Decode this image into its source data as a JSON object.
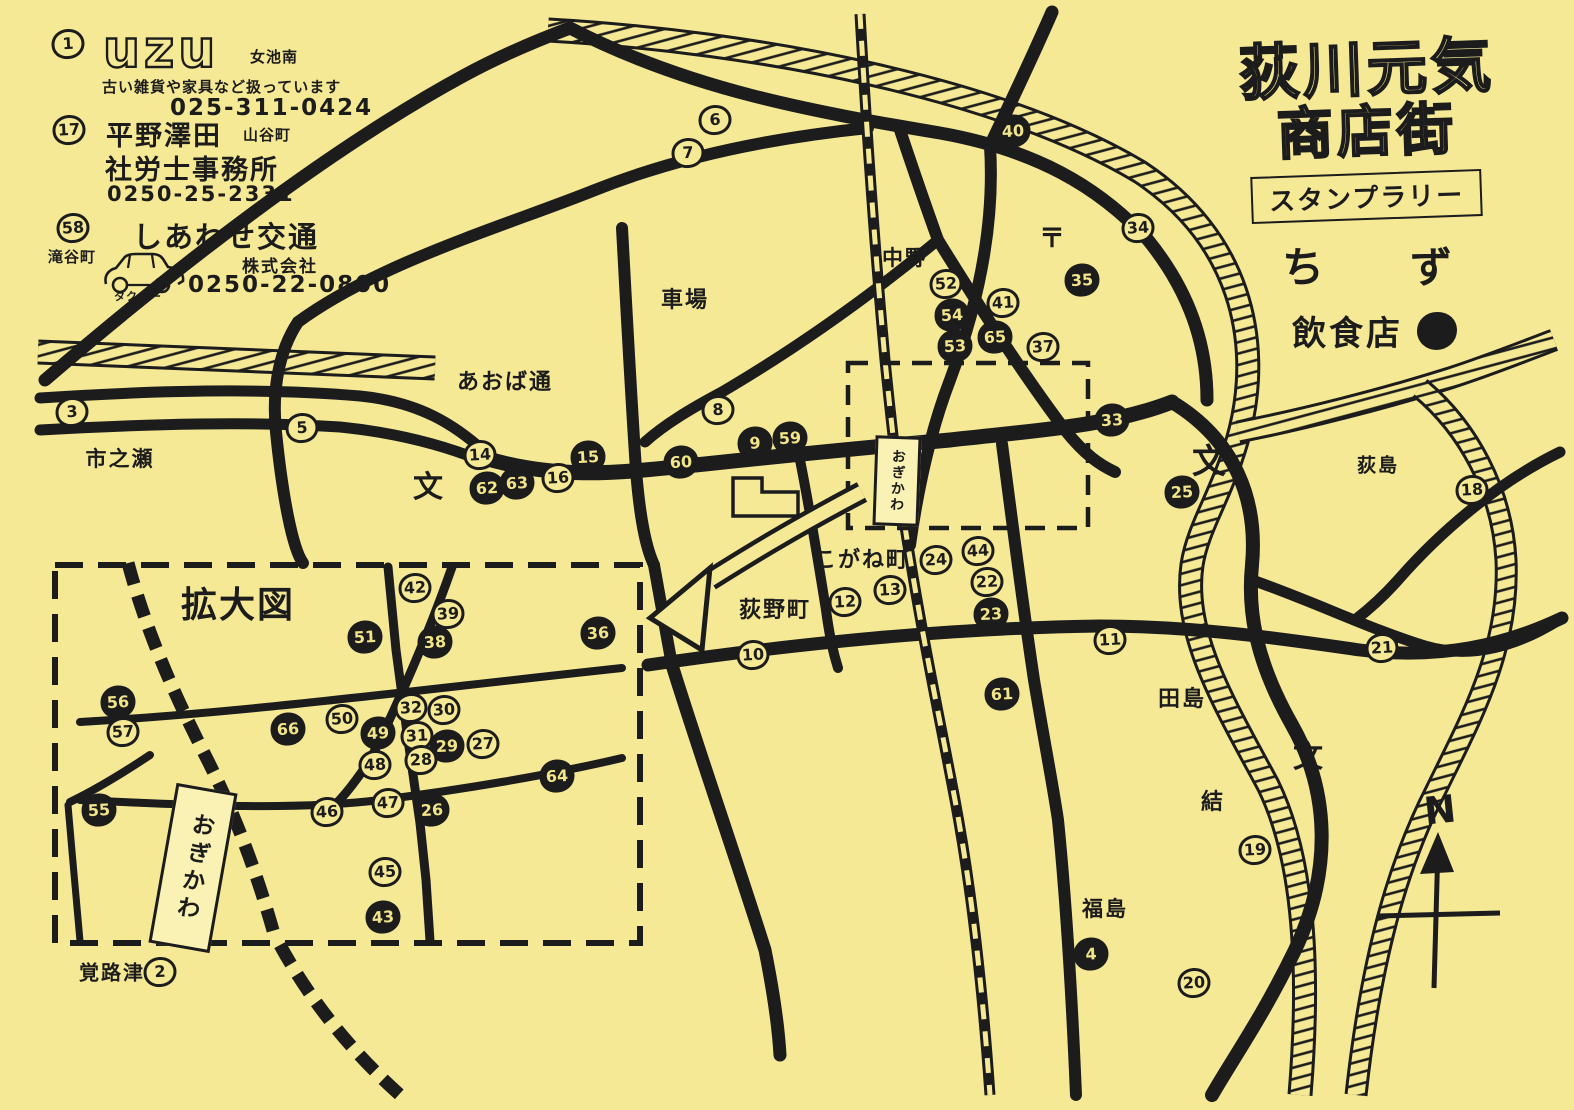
{
  "page": {
    "paper_color": "#f5e996",
    "ink_color": "#1c1c1c"
  },
  "title": {
    "line1": "荻川元気",
    "line2": "商店街",
    "banner": "スタンプラリー",
    "subtitle_char1": "ち",
    "subtitle_char2": "ず"
  },
  "legend": {
    "label": "飲食店",
    "symbol": "filled-circle"
  },
  "compass": {
    "label": "N"
  },
  "ads": [
    {
      "number": "1",
      "logo": "uzu",
      "area": "女池南",
      "description": "古い雑貨や家具など扱っています",
      "phone": "025-311-0424"
    },
    {
      "number": "17",
      "line1": "平野澤田",
      "area": "山谷町",
      "line2": "社労士事務所",
      "phone": "0250-25-2331"
    },
    {
      "number": "58",
      "line1": "しあわせ交通",
      "line2": "株式会社",
      "area": "滝谷町",
      "icon": "taxi",
      "icon_label": "タクシー",
      "phone": "0250-22-0800"
    }
  ],
  "map": {
    "inset_label": "拡大図",
    "station_name": "おぎかわ",
    "stations": [
      {
        "name": "おぎかわ",
        "x": 897,
        "y": 481,
        "w": 46,
        "h": 90,
        "rot": 2,
        "font": 14,
        "spacing": 2
      },
      {
        "name": "おぎかわ",
        "x": 193,
        "y": 868,
        "w": 62,
        "h": 162,
        "rot": 10,
        "font": 23,
        "spacing": 5
      }
    ],
    "places": [
      {
        "text": "市之瀬",
        "x": 120,
        "y": 458,
        "size": 21
      },
      {
        "text": "あおば通",
        "x": 505,
        "y": 380,
        "size": 22
      },
      {
        "text": "車場",
        "x": 685,
        "y": 298,
        "size": 22
      },
      {
        "text": "中野",
        "x": 905,
        "y": 257,
        "size": 21
      },
      {
        "text": "こがね町",
        "x": 862,
        "y": 558,
        "size": 22
      },
      {
        "text": "荻野町",
        "x": 775,
        "y": 608,
        "size": 22
      },
      {
        "text": "田島",
        "x": 1182,
        "y": 697,
        "size": 22
      },
      {
        "text": "結",
        "x": 1213,
        "y": 800,
        "size": 22
      },
      {
        "text": "福島",
        "x": 1105,
        "y": 908,
        "size": 21
      },
      {
        "text": "荻島",
        "x": 1378,
        "y": 464,
        "size": 19
      },
      {
        "text": "覚路津",
        "x": 112,
        "y": 971,
        "size": 20
      },
      {
        "text": "拡大図",
        "x": 238,
        "y": 602,
        "size": 36
      }
    ],
    "symbols": [
      {
        "char": "文",
        "meaning": "school",
        "x": 428,
        "y": 488,
        "size": 30
      },
      {
        "char": "文",
        "meaning": "school",
        "x": 1209,
        "y": 462,
        "size": 34
      },
      {
        "char": "文",
        "meaning": "school",
        "x": 1308,
        "y": 758,
        "size": 30
      },
      {
        "char": "〒",
        "meaning": "post-office",
        "x": 1052,
        "y": 239,
        "size": 26
      }
    ],
    "markers": [
      {
        "label": "1",
        "x": 68,
        "y": 44,
        "filled": false,
        "area": "ad"
      },
      {
        "label": "17",
        "x": 69,
        "y": 130,
        "filled": false,
        "area": "ad"
      },
      {
        "label": "58",
        "x": 73,
        "y": 228,
        "filled": false,
        "area": "ad"
      },
      {
        "label": "3",
        "x": 72,
        "y": 412,
        "filled": false,
        "area": "main"
      },
      {
        "label": "5",
        "x": 302,
        "y": 428,
        "filled": false,
        "area": "main"
      },
      {
        "label": "6",
        "x": 715,
        "y": 120,
        "filled": false,
        "area": "main"
      },
      {
        "label": "7",
        "x": 688,
        "y": 153,
        "filled": false,
        "area": "main"
      },
      {
        "label": "8",
        "x": 718,
        "y": 410,
        "filled": false,
        "area": "main"
      },
      {
        "label": "14",
        "x": 480,
        "y": 455,
        "filled": false,
        "area": "main"
      },
      {
        "label": "62",
        "x": 487,
        "y": 488,
        "filled": true,
        "area": "main"
      },
      {
        "label": "63",
        "x": 517,
        "y": 483,
        "filled": true,
        "area": "main"
      },
      {
        "label": "16",
        "x": 558,
        "y": 478,
        "filled": false,
        "area": "main"
      },
      {
        "label": "15",
        "x": 588,
        "y": 457,
        "filled": true,
        "area": "main"
      },
      {
        "label": "60",
        "x": 681,
        "y": 462,
        "filled": true,
        "area": "main"
      },
      {
        "label": "9",
        "x": 755,
        "y": 443,
        "filled": true,
        "area": "main"
      },
      {
        "label": "59",
        "x": 790,
        "y": 438,
        "filled": true,
        "area": "main"
      },
      {
        "label": "40",
        "x": 1013,
        "y": 131,
        "filled": true,
        "area": "main"
      },
      {
        "label": "34",
        "x": 1138,
        "y": 228,
        "filled": false,
        "area": "main"
      },
      {
        "label": "35",
        "x": 1082,
        "y": 280,
        "filled": true,
        "area": "main"
      },
      {
        "label": "52",
        "x": 946,
        "y": 284,
        "filled": false,
        "area": "main"
      },
      {
        "label": "54",
        "x": 952,
        "y": 315,
        "filled": true,
        "area": "main"
      },
      {
        "label": "53",
        "x": 955,
        "y": 346,
        "filled": true,
        "area": "main"
      },
      {
        "label": "41",
        "x": 1003,
        "y": 303,
        "filled": false,
        "area": "main"
      },
      {
        "label": "65",
        "x": 995,
        "y": 337,
        "filled": true,
        "area": "main"
      },
      {
        "label": "37",
        "x": 1043,
        "y": 347,
        "filled": false,
        "area": "main"
      },
      {
        "label": "33",
        "x": 1112,
        "y": 420,
        "filled": true,
        "area": "main"
      },
      {
        "label": "25",
        "x": 1182,
        "y": 492,
        "filled": true,
        "area": "main"
      },
      {
        "label": "18",
        "x": 1472,
        "y": 490,
        "filled": false,
        "area": "main"
      },
      {
        "label": "21",
        "x": 1382,
        "y": 648,
        "filled": false,
        "area": "main"
      },
      {
        "label": "11",
        "x": 1110,
        "y": 640,
        "filled": false,
        "area": "main"
      },
      {
        "label": "24",
        "x": 936,
        "y": 560,
        "filled": false,
        "area": "main"
      },
      {
        "label": "44",
        "x": 978,
        "y": 551,
        "filled": false,
        "area": "main"
      },
      {
        "label": "22",
        "x": 987,
        "y": 582,
        "filled": false,
        "area": "main"
      },
      {
        "label": "23",
        "x": 991,
        "y": 614,
        "filled": true,
        "area": "main"
      },
      {
        "label": "13",
        "x": 890,
        "y": 590,
        "filled": false,
        "area": "main"
      },
      {
        "label": "12",
        "x": 845,
        "y": 602,
        "filled": false,
        "area": "main"
      },
      {
        "label": "10",
        "x": 753,
        "y": 655,
        "filled": false,
        "area": "main"
      },
      {
        "label": "61",
        "x": 1002,
        "y": 694,
        "filled": true,
        "area": "main"
      },
      {
        "label": "19",
        "x": 1255,
        "y": 850,
        "filled": false,
        "area": "main"
      },
      {
        "label": "20",
        "x": 1194,
        "y": 983,
        "filled": false,
        "area": "main"
      },
      {
        "label": "4",
        "x": 1091,
        "y": 954,
        "filled": true,
        "area": "main"
      },
      {
        "label": "2",
        "x": 160,
        "y": 972,
        "filled": false,
        "area": "main"
      },
      {
        "label": "42",
        "x": 415,
        "y": 588,
        "filled": false,
        "area": "inset"
      },
      {
        "label": "39",
        "x": 448,
        "y": 614,
        "filled": false,
        "area": "inset"
      },
      {
        "label": "51",
        "x": 365,
        "y": 637,
        "filled": true,
        "area": "inset"
      },
      {
        "label": "38",
        "x": 435,
        "y": 642,
        "filled": true,
        "area": "inset"
      },
      {
        "label": "36",
        "x": 598,
        "y": 633,
        "filled": true,
        "area": "inset"
      },
      {
        "label": "56",
        "x": 118,
        "y": 702,
        "filled": true,
        "area": "inset"
      },
      {
        "label": "57",
        "x": 123,
        "y": 732,
        "filled": false,
        "area": "inset"
      },
      {
        "label": "66",
        "x": 288,
        "y": 729,
        "filled": true,
        "area": "inset"
      },
      {
        "label": "50",
        "x": 342,
        "y": 719,
        "filled": false,
        "area": "inset"
      },
      {
        "label": "49",
        "x": 378,
        "y": 733,
        "filled": true,
        "area": "inset"
      },
      {
        "label": "32",
        "x": 411,
        "y": 708,
        "filled": false,
        "area": "inset"
      },
      {
        "label": "30",
        "x": 444,
        "y": 710,
        "filled": false,
        "area": "inset"
      },
      {
        "label": "31",
        "x": 417,
        "y": 736,
        "filled": false,
        "area": "inset"
      },
      {
        "label": "29",
        "x": 447,
        "y": 746,
        "filled": true,
        "area": "inset"
      },
      {
        "label": "27",
        "x": 483,
        "y": 744,
        "filled": false,
        "area": "inset"
      },
      {
        "label": "48",
        "x": 375,
        "y": 765,
        "filled": false,
        "area": "inset"
      },
      {
        "label": "28",
        "x": 421,
        "y": 760,
        "filled": false,
        "area": "inset"
      },
      {
        "label": "64",
        "x": 557,
        "y": 776,
        "filled": true,
        "area": "inset"
      },
      {
        "label": "55",
        "x": 99,
        "y": 810,
        "filled": true,
        "area": "inset"
      },
      {
        "label": "46",
        "x": 327,
        "y": 812,
        "filled": false,
        "area": "inset"
      },
      {
        "label": "47",
        "x": 388,
        "y": 803,
        "filled": false,
        "area": "inset"
      },
      {
        "label": "26",
        "x": 432,
        "y": 810,
        "filled": true,
        "area": "inset"
      },
      {
        "label": "45",
        "x": 385,
        "y": 872,
        "filled": false,
        "area": "inset"
      },
      {
        "label": "43",
        "x": 383,
        "y": 917,
        "filled": true,
        "area": "inset"
      }
    ]
  }
}
